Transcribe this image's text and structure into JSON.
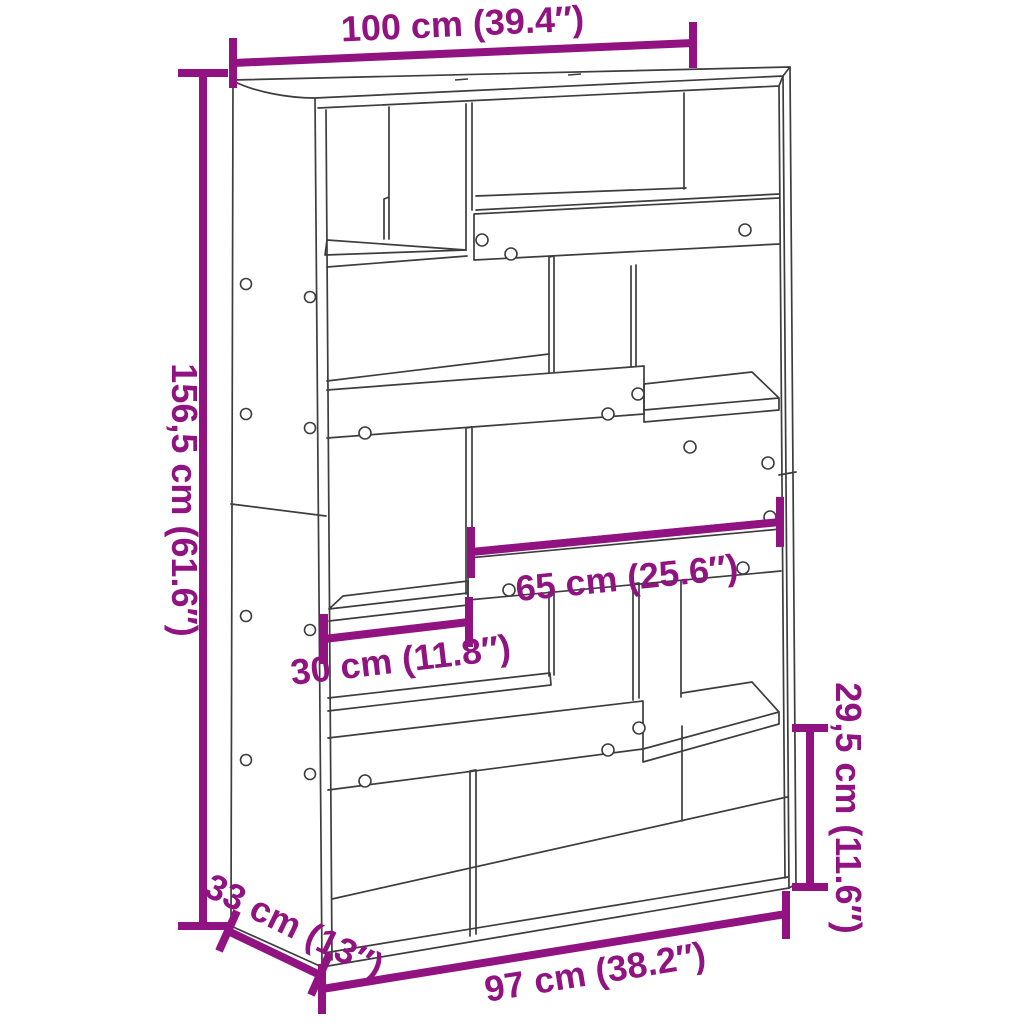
{
  "diagram": {
    "kind": "furniture-dimension-diagram",
    "subject": "bookcase-room-divider",
    "background_color": "#FFFFFF",
    "line_color": "#3D3D3D",
    "accent_color": "#911382",
    "dimensions": {
      "top_width": "100 cm (39.4″)",
      "height": "156,5 cm (61.6″)",
      "middle_shelf_width": "65 cm (25.6″)",
      "left_shelf_width": "30 cm (11.8″)",
      "lower_right_height": "29,5 cm (11.6″)",
      "depth": "33 cm (13″)",
      "bottom_width": "97 cm (38.2″)"
    }
  }
}
